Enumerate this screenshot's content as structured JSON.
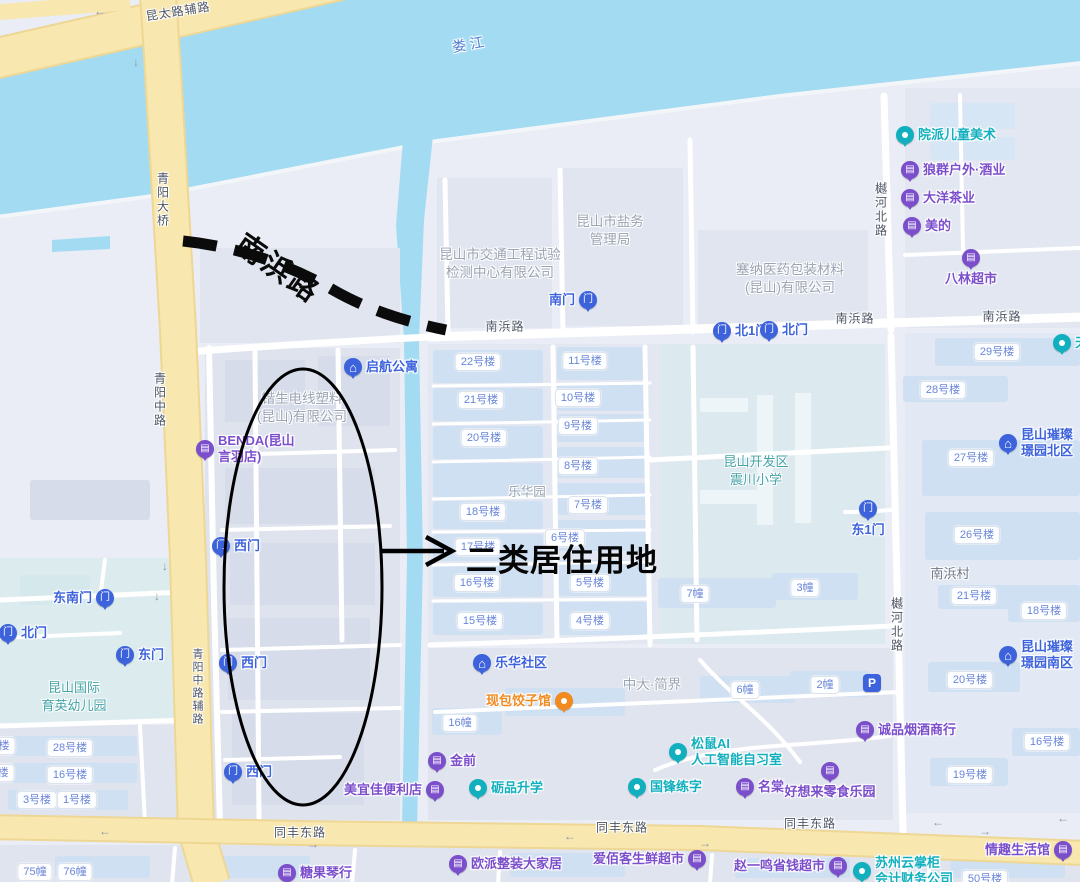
{
  "colors": {
    "water": "#a3dcf2",
    "land": "#eaedf5",
    "block": "#dfe4ee",
    "building": "#cfe0f2",
    "yellow_road": "#f8e7ae",
    "blue": "#3d63dc",
    "purple": "#7b4ecb",
    "teal": "#12b0bf",
    "orange": "#f18a1f",
    "pill_text": "#6b86d8",
    "gray_text": "#9aa3b3",
    "annotation": "#000000"
  },
  "annotations": {
    "road_name": {
      "text": "南浜路"
    },
    "callout": {
      "text": "二类居住用地"
    }
  },
  "road_labels": [
    {
      "text": "昆太路辅路",
      "x": 178,
      "y": 11,
      "rot": -9
    },
    {
      "text": "娄江",
      "x": 470,
      "y": 44,
      "rot": -10,
      "color": "#4f7fd2",
      "size": 14,
      "spacing": 4
    },
    {
      "text": "青阳大桥",
      "x": 163,
      "y": 172,
      "vertical": true
    },
    {
      "text": "青阳中路",
      "x": 160,
      "y": 372,
      "vertical": true
    },
    {
      "text": "青阳中路辅路",
      "x": 197,
      "y": 648,
      "vertical": true,
      "size": 11
    },
    {
      "text": "南浜路",
      "x": 505,
      "y": 326
    },
    {
      "text": "南浜路",
      "x": 855,
      "y": 318
    },
    {
      "text": "南浜路",
      "x": 1002,
      "y": 316
    },
    {
      "text": "樾河北路",
      "x": 881,
      "y": 182,
      "vertical": true
    },
    {
      "text": "樾河北路",
      "x": 897,
      "y": 597,
      "vertical": true
    },
    {
      "text": "同丰东路",
      "x": 300,
      "y": 832
    },
    {
      "text": "同丰东路",
      "x": 622,
      "y": 827
    },
    {
      "text": "同丰东路",
      "x": 810,
      "y": 823
    }
  ],
  "area_labels": [
    {
      "lines": [
        "昆山市交通工程试验",
        "检测中心有限公司"
      ],
      "x": 500,
      "y": 246,
      "color": "#9aa3b3",
      "size": 13.5
    },
    {
      "lines": [
        "昆山市盐务",
        "管理局"
      ],
      "x": 610,
      "y": 213,
      "color": "#9aa3b3",
      "size": 13.5
    },
    {
      "lines": [
        "塞纳医药包装材料",
        "(昆山)有限公司"
      ],
      "x": 790,
      "y": 261,
      "color": "#9aa3b3",
      "size": 13.5
    },
    {
      "lines": [
        "锴生电线塑料",
        "(昆山)有限公司"
      ],
      "x": 302,
      "y": 390,
      "color": "#9aa3b3",
      "size": 13.5
    },
    {
      "lines": [
        "乐华园"
      ],
      "x": 527,
      "y": 484,
      "color": "#9aa3b3",
      "size": 12.5
    },
    {
      "lines": [
        "中大·简界"
      ],
      "x": 652,
      "y": 676,
      "color": "#9aa3b3",
      "size": 13.5
    },
    {
      "lines": [
        "南浜村"
      ],
      "x": 950,
      "y": 565,
      "color": "#6e7584",
      "size": 13
    },
    {
      "lines": [
        "昆山国际",
        "育英幼儿园"
      ],
      "x": 74,
      "y": 679,
      "color": "#45a3a6",
      "size": 13
    },
    {
      "lines": [
        "昆山开发区",
        "震川小学"
      ],
      "x": 756,
      "y": 453,
      "color": "#45a3a6",
      "size": 13
    }
  ],
  "pills": [
    {
      "text": "22号楼",
      "x": 478,
      "y": 362
    },
    {
      "text": "11号楼",
      "x": 585,
      "y": 361
    },
    {
      "text": "21号楼",
      "x": 481,
      "y": 400
    },
    {
      "text": "10号楼",
      "x": 578,
      "y": 398
    },
    {
      "text": "9号楼",
      "x": 578,
      "y": 426
    },
    {
      "text": "20号楼",
      "x": 484,
      "y": 438
    },
    {
      "text": "8号楼",
      "x": 578,
      "y": 466
    },
    {
      "text": "7号楼",
      "x": 588,
      "y": 505
    },
    {
      "text": "18号楼",
      "x": 483,
      "y": 512
    },
    {
      "text": "17号楼",
      "x": 478,
      "y": 547
    },
    {
      "text": "6号楼",
      "x": 565,
      "y": 538
    },
    {
      "text": "16号楼",
      "x": 477,
      "y": 583
    },
    {
      "text": "5号楼",
      "x": 590,
      "y": 583
    },
    {
      "text": "15号楼",
      "x": 480,
      "y": 621
    },
    {
      "text": "4号楼",
      "x": 590,
      "y": 621
    },
    {
      "text": "29号楼",
      "x": 997,
      "y": 352
    },
    {
      "text": "28号楼",
      "x": 943,
      "y": 390
    },
    {
      "text": "27号楼",
      "x": 971,
      "y": 458
    },
    {
      "text": "26号楼",
      "x": 977,
      "y": 535
    },
    {
      "text": "21号楼",
      "x": 974,
      "y": 596
    },
    {
      "text": "18号楼",
      "x": 1044,
      "y": 611
    },
    {
      "text": "20号楼",
      "x": 970,
      "y": 680
    },
    {
      "text": "16号楼",
      "x": 1047,
      "y": 742
    },
    {
      "text": "19号楼",
      "x": 970,
      "y": 775
    },
    {
      "text": "50号楼",
      "x": 985,
      "y": 879
    },
    {
      "text": "7幢",
      "x": 695,
      "y": 594
    },
    {
      "text": "3幢",
      "x": 805,
      "y": 588
    },
    {
      "text": "6幢",
      "x": 745,
      "y": 690
    },
    {
      "text": "2幢",
      "x": 825,
      "y": 685
    },
    {
      "text": "16幢",
      "x": 460,
      "y": 723
    },
    {
      "text": "28号楼",
      "x": 70,
      "y": 748
    },
    {
      "text": "16号楼",
      "x": 70,
      "y": 775
    },
    {
      "text": "3号楼",
      "x": 37,
      "y": 800
    },
    {
      "text": "1号楼",
      "x": 77,
      "y": 800
    },
    {
      "text": "楼",
      "x": 4,
      "y": 746
    },
    {
      "text": "楼",
      "x": 3,
      "y": 773
    },
    {
      "text": "75幢",
      "x": 35,
      "y": 872
    },
    {
      "text": "76幢",
      "x": 75,
      "y": 872
    }
  ],
  "pois": [
    {
      "name": "gate-nanmen",
      "lines": [
        "南门"
      ],
      "x": 588,
      "y": 300,
      "color": "blue",
      "glyph": "door",
      "side": "left"
    },
    {
      "name": "gate-bei1men",
      "lines": [
        "北1门"
      ],
      "x": 722,
      "y": 331,
      "color": "blue",
      "glyph": "door",
      "side": "right"
    },
    {
      "name": "gate-beimen-e",
      "lines": [
        "北门"
      ],
      "x": 769,
      "y": 330,
      "color": "blue",
      "glyph": "door",
      "side": "right"
    },
    {
      "name": "gate-dong1men",
      "lines": [
        "东1门"
      ],
      "x": 868,
      "y": 509,
      "color": "blue",
      "glyph": "door",
      "side": "below"
    },
    {
      "name": "gate-dongnanmen",
      "lines": [
        "东南门"
      ],
      "x": 105,
      "y": 598,
      "color": "blue",
      "glyph": "door",
      "side": "left"
    },
    {
      "name": "gate-beimen-w",
      "lines": [
        "北门"
      ],
      "x": 8,
      "y": 633,
      "color": "blue",
      "glyph": "door",
      "side": "right"
    },
    {
      "name": "gate-dongmen",
      "lines": [
        "东门"
      ],
      "x": 125,
      "y": 655,
      "color": "blue",
      "glyph": "door",
      "side": "right"
    },
    {
      "name": "gate-ximen-1",
      "lines": [
        "西门"
      ],
      "x": 221,
      "y": 546,
      "color": "blue",
      "glyph": "door",
      "side": "right"
    },
    {
      "name": "gate-ximen-2",
      "lines": [
        "西门"
      ],
      "x": 228,
      "y": 663,
      "color": "blue",
      "glyph": "door",
      "side": "right"
    },
    {
      "name": "gate-ximen-3",
      "lines": [
        "西门"
      ],
      "x": 233,
      "y": 772,
      "color": "blue",
      "glyph": "door",
      "side": "right"
    },
    {
      "name": "qihang-apartment",
      "lines": [
        "启航公寓"
      ],
      "x": 353,
      "y": 367,
      "color": "blue",
      "glyph": "house",
      "side": "right"
    },
    {
      "name": "lehua-community",
      "lines": [
        "乐华社区"
      ],
      "x": 482,
      "y": 663,
      "color": "blue",
      "glyph": "house",
      "side": "right"
    },
    {
      "name": "cuican-north",
      "lines": [
        "昆山璀璨",
        "璟园北区"
      ],
      "x": 1008,
      "y": 443,
      "color": "blue",
      "glyph": "house",
      "side": "right"
    },
    {
      "name": "cuican-south",
      "lines": [
        "昆山璀璨",
        "璟园南区"
      ],
      "x": 1008,
      "y": 655,
      "color": "blue",
      "glyph": "house",
      "side": "right"
    },
    {
      "name": "parking",
      "lines": [],
      "x": 872,
      "y": 683,
      "color": "blue",
      "glyph": "P",
      "shape": "square"
    },
    {
      "name": "yuanpai-art",
      "lines": [
        "院派儿童美术"
      ],
      "x": 905,
      "y": 135,
      "color": "teal",
      "glyph": "dot",
      "side": "right"
    },
    {
      "name": "lipin-edu",
      "lines": [
        "砺品升学"
      ],
      "x": 478,
      "y": 788,
      "color": "teal",
      "glyph": "dot",
      "side": "right"
    },
    {
      "name": "guofeng-calligraphy",
      "lines": [
        "国锋练字"
      ],
      "x": 637,
      "y": 787,
      "color": "teal",
      "glyph": "dot",
      "side": "right"
    },
    {
      "name": "songshu-ai",
      "lines": [
        "松鼠AI",
        "人工智能自习室"
      ],
      "x": 678,
      "y": 752,
      "color": "teal",
      "glyph": "dot",
      "side": "right"
    },
    {
      "name": "suzhou-yunzhanggui",
      "lines": [
        "苏州云掌柜",
        "会计财务公司"
      ],
      "x": 862,
      "y": 871,
      "color": "teal",
      "glyph": "dot",
      "side": "right"
    },
    {
      "name": "tian-partial",
      "lines": [
        "天"
      ],
      "x": 1062,
      "y": 343,
      "color": "teal",
      "glyph": "dot",
      "side": "right"
    },
    {
      "name": "langqun-outdoor",
      "lines": [
        "狼群户外·酒业"
      ],
      "x": 910,
      "y": 170,
      "color": "purple",
      "glyph": "shop",
      "side": "right"
    },
    {
      "name": "dayang-tea",
      "lines": [
        "大洋茶业"
      ],
      "x": 910,
      "y": 198,
      "color": "purple",
      "glyph": "shop",
      "side": "right"
    },
    {
      "name": "meidi",
      "lines": [
        "美的"
      ],
      "x": 912,
      "y": 226,
      "color": "purple",
      "glyph": "shop",
      "side": "right"
    },
    {
      "name": "balin-market",
      "lines": [
        "八林超市"
      ],
      "x": 971,
      "y": 258,
      "color": "purple",
      "glyph": "shop",
      "side": "below"
    },
    {
      "name": "benda",
      "lines": [
        "BENDA(昆山",
        "言羽店)"
      ],
      "x": 205,
      "y": 449,
      "color": "purple",
      "glyph": "shop",
      "side": "right"
    },
    {
      "name": "jinqian",
      "lines": [
        "金前"
      ],
      "x": 437,
      "y": 761,
      "color": "purple",
      "glyph": "shop",
      "side": "right"
    },
    {
      "name": "meiyijia",
      "lines": [
        "美宜佳便利店"
      ],
      "x": 435,
      "y": 790,
      "color": "purple",
      "glyph": "shop",
      "side": "left"
    },
    {
      "name": "mingtang",
      "lines": [
        "名棠"
      ],
      "x": 745,
      "y": 787,
      "color": "purple",
      "glyph": "shop",
      "side": "right"
    },
    {
      "name": "haoxianglai-snacks",
      "lines": [
        "好想来零食乐园"
      ],
      "x": 830,
      "y": 771,
      "color": "purple",
      "glyph": "shop",
      "side": "below"
    },
    {
      "name": "chengpin-tobacco",
      "lines": [
        "诚品烟酒商行"
      ],
      "x": 865,
      "y": 730,
      "color": "purple",
      "glyph": "shop",
      "side": "right"
    },
    {
      "name": "zhaoyiming-market",
      "lines": [
        "赵一鸣省钱超市"
      ],
      "x": 838,
      "y": 866,
      "color": "purple",
      "glyph": "shop",
      "side": "left"
    },
    {
      "name": "qingqu-life",
      "lines": [
        "情趣生活馆"
      ],
      "x": 1063,
      "y": 850,
      "color": "purple",
      "glyph": "shop",
      "side": "left"
    },
    {
      "name": "tangguo-piano",
      "lines": [
        "糖果琴行"
      ],
      "x": 287,
      "y": 873,
      "color": "purple",
      "glyph": "shop",
      "side": "right"
    },
    {
      "name": "oupai-home",
      "lines": [
        "欧派整装大家居"
      ],
      "x": 458,
      "y": 864,
      "color": "purple",
      "glyph": "shop",
      "side": "right"
    },
    {
      "name": "aibaike-market",
      "lines": [
        "爱佰客生鲜超市"
      ],
      "x": 697,
      "y": 859,
      "color": "purple",
      "glyph": "shop",
      "side": "left"
    },
    {
      "name": "xianbao-dumplings",
      "lines": [
        "现包饺子馆"
      ],
      "x": 564,
      "y": 701,
      "color": "orange",
      "glyph": "dot",
      "side": "left"
    }
  ],
  "arrows": [
    {
      "ch": "←",
      "x": 100,
      "y": 11
    },
    {
      "ch": "→",
      "x": 173,
      "y": 9
    },
    {
      "ch": "↓",
      "x": 136,
      "y": 62
    },
    {
      "ch": "↓",
      "x": 165,
      "y": 566
    },
    {
      "ch": "↓",
      "x": 157,
      "y": 596
    },
    {
      "ch": "←",
      "x": 105,
      "y": 831
    },
    {
      "ch": "→",
      "x": 313,
      "y": 844
    },
    {
      "ch": "←",
      "x": 570,
      "y": 836
    },
    {
      "ch": "→",
      "x": 705,
      "y": 843
    },
    {
      "ch": "←",
      "x": 938,
      "y": 822
    },
    {
      "ch": "→",
      "x": 985,
      "y": 831
    },
    {
      "ch": "←",
      "x": 1063,
      "y": 818
    }
  ]
}
